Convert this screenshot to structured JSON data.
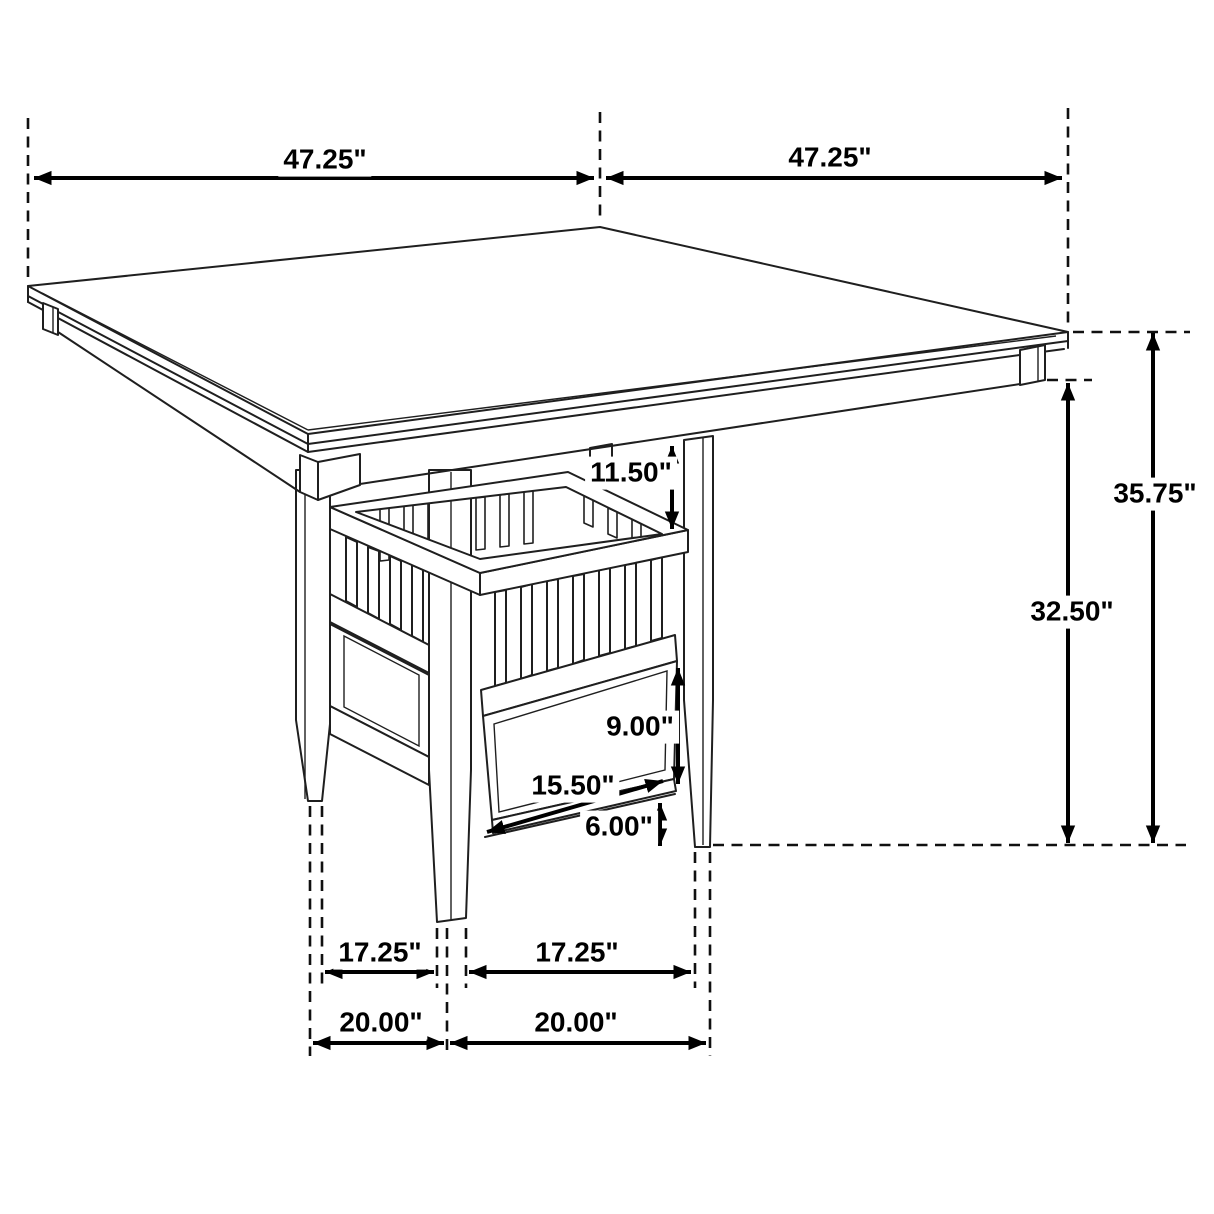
{
  "figure": {
    "subject": "Square counter-height dining table with slatted storage shelf and storage drawer pedestal base",
    "style": "black and white isometric dimension line drawing",
    "background": "#ffffff",
    "line_color": "#1f1f1f",
    "dimension_color": "#000000",
    "units": "inches"
  },
  "dims": {
    "top_width": {
      "label": "47.25\"",
      "measures": "tabletop edge, left corner to back corner"
    },
    "top_depth": {
      "label": "47.25\"",
      "measures": "tabletop edge, back corner to right corner"
    },
    "overall_height": {
      "label": "35.75\"",
      "measures": "floor to tabletop surface"
    },
    "underside_height": {
      "label": "32.50\"",
      "measures": "floor to apron underside"
    },
    "top_to_shelf": {
      "label": "11.50\"",
      "measures": "tabletop underside to shelf rim"
    },
    "drawer_height": {
      "label": "9.00\"",
      "measures": "drawer front height"
    },
    "drawer_width": {
      "label": "15.50\"",
      "measures": "drawer front width"
    },
    "floor_clearance": {
      "label": "6.00\"",
      "measures": "floor to bottom rail"
    },
    "inner_span_left": {
      "label": "17.25\"",
      "measures": "inner span between left and front feet"
    },
    "inner_span_right": {
      "label": "17.25\"",
      "measures": "inner span between front and right feet"
    },
    "outer_span_left": {
      "label": "20.00\"",
      "measures": "outer span between left and front feet"
    },
    "outer_span_right": {
      "label": "20.00\"",
      "measures": "outer span between front and right feet"
    }
  }
}
